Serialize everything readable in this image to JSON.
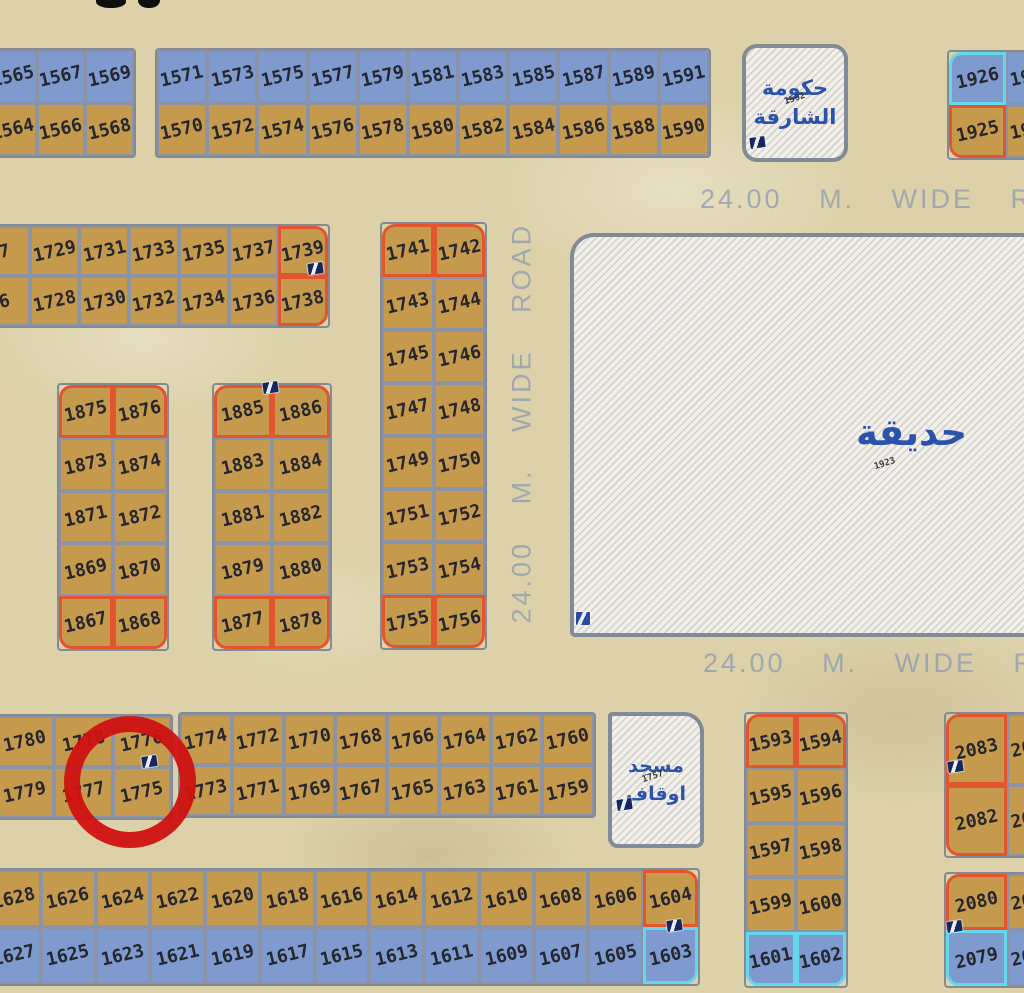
{
  "map": {
    "colors": {
      "sand": "#dcd1a8",
      "plot_tan": "#c59a4d",
      "plot_blue": "#7e9ace",
      "grid_line": "#8a94a6",
      "block_border": "#828a96",
      "highlight_orange": "#e2552e",
      "highlight_cyan": "#63d8e8",
      "number_ink": "#26262e",
      "road_text": "#8f9cb2",
      "arabic_blue": "#2b53ab",
      "hatch_bg": "#f3f0e9",
      "annotation_red": "#cf1110"
    },
    "blocks": [
      {
        "name": "block-1564-1569",
        "x": -14,
        "y": 48,
        "w": 150,
        "h": 110,
        "rows": [
          [
            {
              "n": "1565",
              "c": "b"
            },
            {
              "n": "1567",
              "c": "b"
            },
            {
              "n": "1569",
              "c": "b"
            }
          ],
          [
            {
              "n": "1564"
            },
            {
              "n": "1566"
            },
            {
              "n": "1568"
            }
          ]
        ]
      },
      {
        "name": "block-1570-1591",
        "x": 155,
        "y": 48,
        "w": 556,
        "h": 110,
        "rows": [
          [
            {
              "n": "1571",
              "c": "b"
            },
            {
              "n": "1573",
              "c": "b"
            },
            {
              "n": "1575",
              "c": "b"
            },
            {
              "n": "1577",
              "c": "b"
            },
            {
              "n": "1579",
              "c": "b"
            },
            {
              "n": "1581",
              "c": "b"
            },
            {
              "n": "1583",
              "c": "b"
            },
            {
              "n": "1585",
              "c": "b"
            },
            {
              "n": "1587",
              "c": "b"
            },
            {
              "n": "1589",
              "c": "b"
            },
            {
              "n": "1591",
              "c": "b"
            }
          ],
          [
            {
              "n": "1570"
            },
            {
              "n": "1572"
            },
            {
              "n": "1574"
            },
            {
              "n": "1576"
            },
            {
              "n": "1578"
            },
            {
              "n": "1580"
            },
            {
              "n": "1582"
            },
            {
              "n": "1584"
            },
            {
              "n": "1586"
            },
            {
              "n": "1588"
            },
            {
              "n": "1590"
            }
          ]
        ]
      },
      {
        "name": "block-1925-1926",
        "x": 947,
        "y": 50,
        "w": 118,
        "h": 110,
        "rows": [
          [
            {
              "n": "1926",
              "c": "b",
              "b": "c",
              "r": "tl"
            },
            {
              "n": "19",
              "c": "b",
              "a": 1
            }
          ],
          [
            {
              "n": "1925",
              "b": "o",
              "r": "bl"
            },
            {
              "n": "19",
              "a": 1
            }
          ]
        ]
      },
      {
        "name": "block-1726-1739",
        "x": -22,
        "y": 224,
        "w": 352,
        "h": 104,
        "rows": [
          [
            {
              "n": "7"
            },
            {
              "n": "1729"
            },
            {
              "n": "1731"
            },
            {
              "n": "1733"
            },
            {
              "n": "1735"
            },
            {
              "n": "1737"
            },
            {
              "n": "1739",
              "b": "o",
              "r": "tr"
            }
          ],
          [
            {
              "n": "6"
            },
            {
              "n": "1728"
            },
            {
              "n": "1730"
            },
            {
              "n": "1732"
            },
            {
              "n": "1734"
            },
            {
              "n": "1736"
            },
            {
              "n": "1738",
              "b": "o",
              "r": "br"
            }
          ]
        ]
      },
      {
        "name": "block-1741-1756",
        "x": 380,
        "y": 222,
        "w": 107,
        "h": 428,
        "rows": [
          [
            {
              "n": "1741",
              "b": "o",
              "r": "tl"
            },
            {
              "n": "1742",
              "b": "o",
              "r": "tr"
            }
          ],
          [
            {
              "n": "1743"
            },
            {
              "n": "1744"
            }
          ],
          [
            {
              "n": "1745"
            },
            {
              "n": "1746"
            }
          ],
          [
            {
              "n": "1747"
            },
            {
              "n": "1748"
            }
          ],
          [
            {
              "n": "1749"
            },
            {
              "n": "1750"
            }
          ],
          [
            {
              "n": "1751"
            },
            {
              "n": "1752"
            }
          ],
          [
            {
              "n": "1753"
            },
            {
              "n": "1754"
            }
          ],
          [
            {
              "n": "1755",
              "b": "o",
              "r": "bl"
            },
            {
              "n": "1756",
              "b": "o",
              "r": "br"
            }
          ]
        ]
      },
      {
        "name": "block-1867-1876",
        "x": 57,
        "y": 383,
        "w": 112,
        "h": 268,
        "rows": [
          [
            {
              "n": "1875",
              "b": "o",
              "r": "tl"
            },
            {
              "n": "1876",
              "b": "o",
              "r": "tr"
            }
          ],
          [
            {
              "n": "1873"
            },
            {
              "n": "1874"
            }
          ],
          [
            {
              "n": "1871"
            },
            {
              "n": "1872"
            }
          ],
          [
            {
              "n": "1869"
            },
            {
              "n": "1870"
            }
          ],
          [
            {
              "n": "1867",
              "b": "o",
              "r": "bl"
            },
            {
              "n": "1868",
              "b": "o",
              "r": "br"
            }
          ]
        ]
      },
      {
        "name": "block-1877-1886",
        "x": 212,
        "y": 383,
        "w": 120,
        "h": 268,
        "rows": [
          [
            {
              "n": "1885",
              "b": "o",
              "r": "tl"
            },
            {
              "n": "1886",
              "b": "o",
              "r": "tr"
            }
          ],
          [
            {
              "n": "1883"
            },
            {
              "n": "1884"
            }
          ],
          [
            {
              "n": "1881"
            },
            {
              "n": "1882"
            }
          ],
          [
            {
              "n": "1879"
            },
            {
              "n": "1880"
            }
          ],
          [
            {
              "n": "1877",
              "b": "o",
              "r": "bl"
            },
            {
              "n": "1878",
              "b": "o",
              "r": "br"
            }
          ]
        ]
      },
      {
        "name": "block-1775-1780",
        "x": -6,
        "y": 714,
        "w": 179,
        "h": 106,
        "rows": [
          [
            {
              "n": "1780"
            },
            {
              "n": "1778"
            },
            {
              "n": "1776"
            }
          ],
          [
            {
              "n": "1779"
            },
            {
              "n": "1777"
            },
            {
              "n": "1775"
            }
          ]
        ]
      },
      {
        "name": "block-1759-1774",
        "x": 178,
        "y": 712,
        "w": 418,
        "h": 106,
        "rows": [
          [
            {
              "n": "1774"
            },
            {
              "n": "1772"
            },
            {
              "n": "1770"
            },
            {
              "n": "1768"
            },
            {
              "n": "1766"
            },
            {
              "n": "1764"
            },
            {
              "n": "1762"
            },
            {
              "n": "1760"
            }
          ],
          [
            {
              "n": "1773"
            },
            {
              "n": "1771"
            },
            {
              "n": "1769"
            },
            {
              "n": "1767"
            },
            {
              "n": "1765"
            },
            {
              "n": "1763"
            },
            {
              "n": "1761"
            },
            {
              "n": "1759"
            }
          ]
        ]
      },
      {
        "name": "block-1593-1602",
        "x": 744,
        "y": 712,
        "w": 104,
        "h": 276,
        "rows": [
          [
            {
              "n": "1593",
              "b": "o",
              "r": "tl"
            },
            {
              "n": "1594",
              "b": "o",
              "r": "tr"
            }
          ],
          [
            {
              "n": "1595"
            },
            {
              "n": "1596"
            }
          ],
          [
            {
              "n": "1597"
            },
            {
              "n": "1598"
            }
          ],
          [
            {
              "n": "1599"
            },
            {
              "n": "1600"
            }
          ],
          [
            {
              "n": "1601",
              "c": "b",
              "b": "c",
              "r": "bl"
            },
            {
              "n": "1602",
              "c": "b",
              "b": "c",
              "r": "br"
            }
          ]
        ]
      },
      {
        "name": "block-2082-2083",
        "x": 944,
        "y": 712,
        "w": 126,
        "h": 146,
        "rows": [
          [
            {
              "n": "2083",
              "b": "o",
              "r": "tl"
            },
            {
              "n": "20",
              "a": 1
            }
          ],
          [
            {
              "n": "2082",
              "b": "o",
              "r": "bl"
            },
            {
              "n": "20",
              "a": 1
            }
          ]
        ]
      },
      {
        "name": "block-2079-2080",
        "x": 944,
        "y": 872,
        "w": 126,
        "h": 116,
        "rows": [
          [
            {
              "n": "2080",
              "b": "o",
              "r": "tl"
            },
            {
              "n": "20",
              "a": 1
            }
          ],
          [
            {
              "n": "2079",
              "c": "b",
              "b": "c",
              "r": "bl"
            },
            {
              "n": "20",
              "c": "b",
              "a": 1
            }
          ]
        ]
      },
      {
        "name": "block-1603-1628",
        "x": -16,
        "y": 868,
        "w": 716,
        "h": 118,
        "rows": [
          [
            {
              "n": "1628"
            },
            {
              "n": "1626"
            },
            {
              "n": "1624"
            },
            {
              "n": "1622"
            },
            {
              "n": "1620"
            },
            {
              "n": "1618"
            },
            {
              "n": "1616"
            },
            {
              "n": "1614"
            },
            {
              "n": "1612"
            },
            {
              "n": "1610"
            },
            {
              "n": "1608"
            },
            {
              "n": "1606"
            },
            {
              "n": "1604",
              "b": "o",
              "r": "tr"
            }
          ],
          [
            {
              "n": "1627",
              "c": "b"
            },
            {
              "n": "1625",
              "c": "b"
            },
            {
              "n": "1623",
              "c": "b"
            },
            {
              "n": "1621",
              "c": "b"
            },
            {
              "n": "1619",
              "c": "b"
            },
            {
              "n": "1617",
              "c": "b"
            },
            {
              "n": "1615",
              "c": "b"
            },
            {
              "n": "1613",
              "c": "b"
            },
            {
              "n": "1611",
              "c": "b"
            },
            {
              "n": "1609",
              "c": "b"
            },
            {
              "n": "1607",
              "c": "b"
            },
            {
              "n": "1605",
              "c": "b"
            },
            {
              "n": "1603",
              "c": "b",
              "b": "c",
              "r": "br"
            }
          ]
        ]
      }
    ],
    "areas": [
      {
        "name": "government-parcel",
        "cls": "gov",
        "x": 742,
        "y": 44,
        "w": 106,
        "h": 118,
        "lines": [
          "حكومة",
          "الشارقة"
        ],
        "tiny": "1592",
        "tx": 38,
        "ty": 46
      },
      {
        "name": "park-parcel",
        "cls": "park",
        "x": 570,
        "y": 233,
        "w": 470,
        "h": 404,
        "lines": [
          "حديقة"
        ],
        "tiny": "1923",
        "tx": 300,
        "ty": 222
      },
      {
        "name": "mosque-parcel",
        "cls": "mosque",
        "x": 608,
        "y": 712,
        "w": 96,
        "h": 136,
        "lines": [
          "مسجد",
          "اوقاف"
        ],
        "tiny": "1757",
        "tx": 30,
        "ty": 56
      }
    ],
    "road_labels": [
      {
        "text": "24.00 M. WIDE ROAD",
        "x": 700,
        "y": 184,
        "rot": 0
      },
      {
        "text": "24.00 M. WIDE ROAD",
        "x": 703,
        "y": 648,
        "rot": 0
      },
      {
        "text": "24.00 M. WIDE ROAD",
        "x": 326,
        "y": 412,
        "rot": -90,
        "w": 392
      }
    ],
    "markers": [
      {
        "x": 308,
        "y": 263
      },
      {
        "x": 263,
        "y": 382
      },
      {
        "x": 576,
        "y": 612,
        "type": "square"
      },
      {
        "x": 750,
        "y": 137
      },
      {
        "x": 142,
        "y": 756
      },
      {
        "x": 617,
        "y": 799
      },
      {
        "x": 948,
        "y": 761
      },
      {
        "x": 947,
        "y": 921
      },
      {
        "x": 667,
        "y": 920
      }
    ],
    "title_remnants": [
      {
        "x": 96,
        "y": -6,
        "w": 30,
        "h": 14
      },
      {
        "x": 138,
        "y": -9,
        "w": 22,
        "h": 17
      }
    ],
    "annotation": {
      "shape": "circle",
      "x": 64,
      "y": 716,
      "d": 132,
      "stroke": 16
    }
  }
}
